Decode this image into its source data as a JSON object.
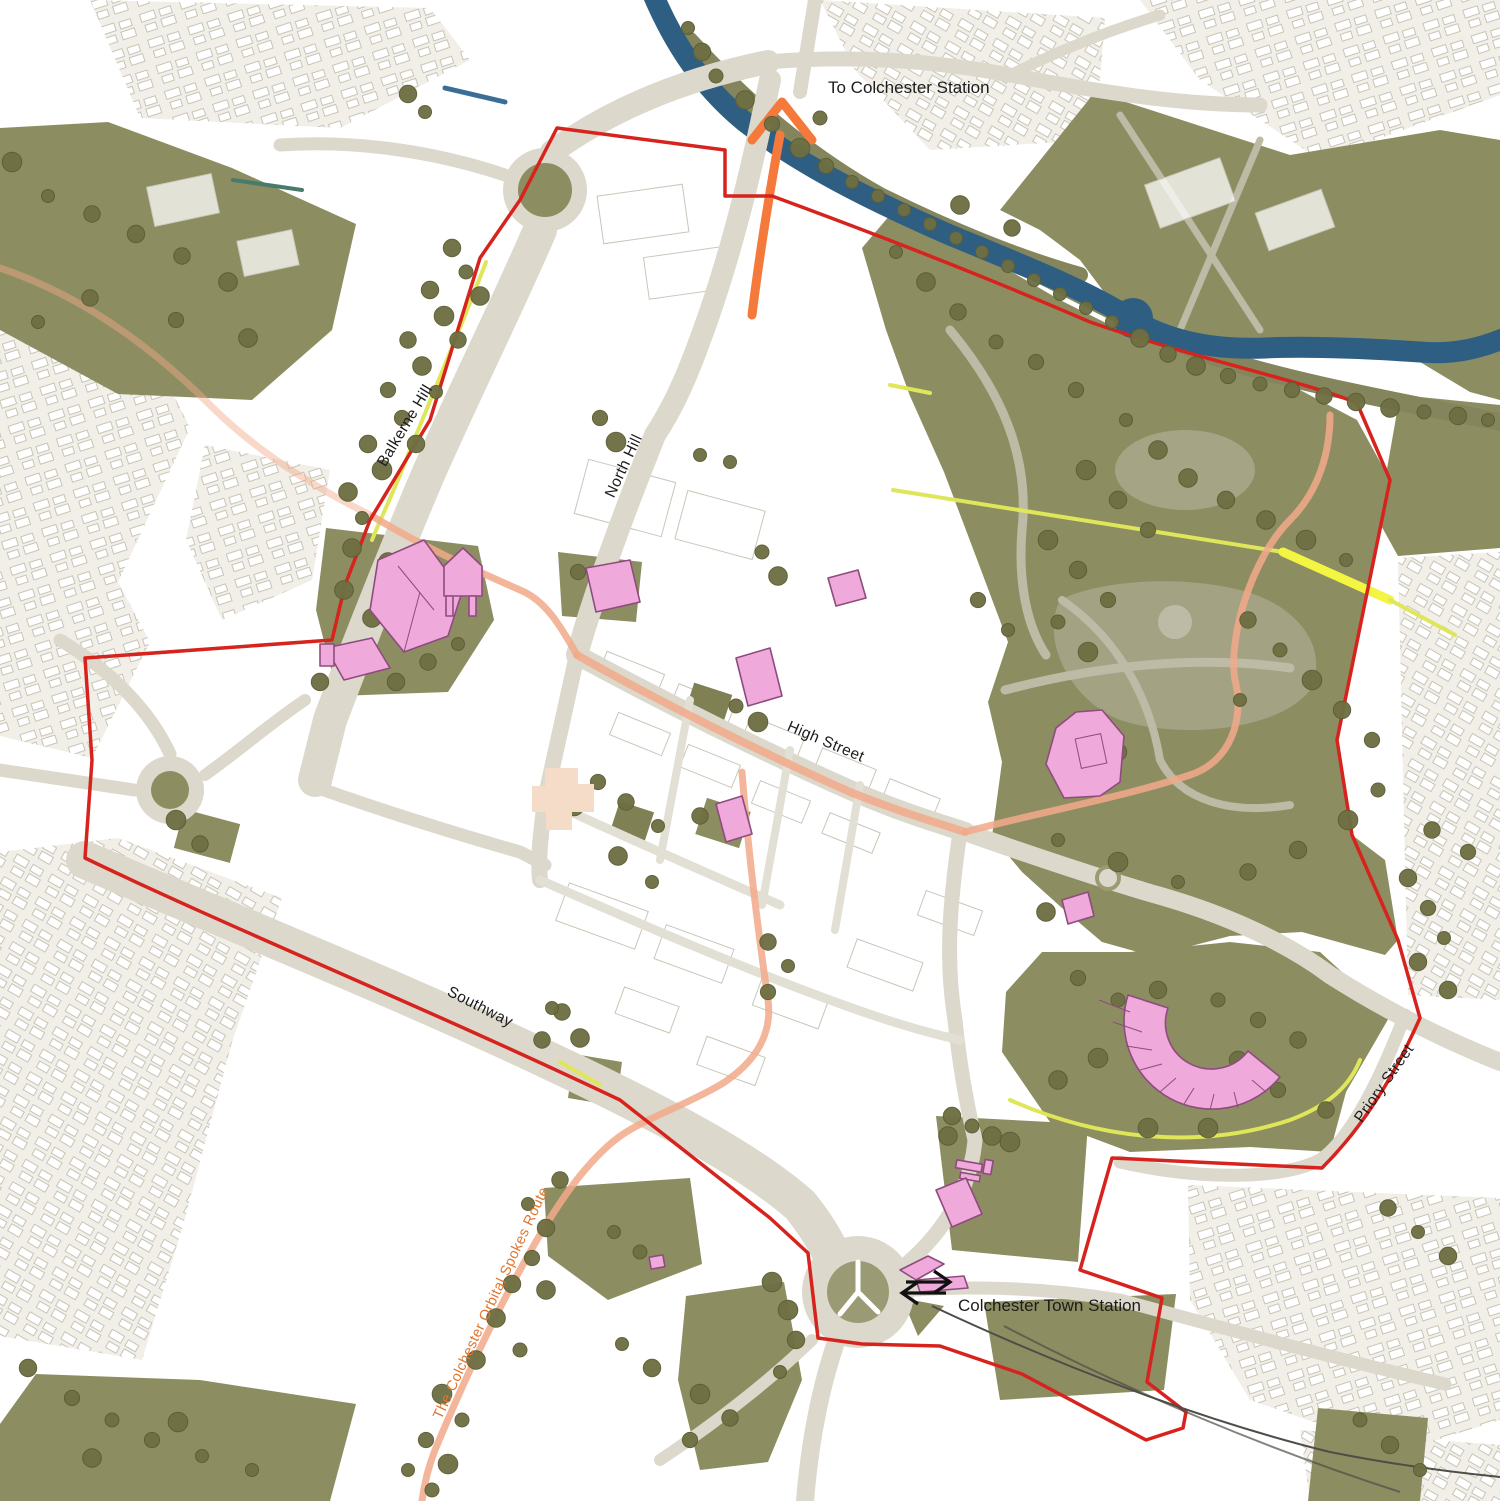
{
  "map": {
    "labels": {
      "to_station": "To Colchester Station",
      "town_station": "Colchester Town Station",
      "balkerne_hill": "Balkerne Hill",
      "north_hill": "North Hill",
      "high_street": "High Street",
      "southway": "Southway",
      "priory_street": "Priory Street",
      "orbital_route": "The Colchester Orbital Spokes Route"
    },
    "colors": {
      "boundary_red": "#d7231d",
      "route_salmon": "#f2a98a",
      "arrow_orange": "#f5793b",
      "cycle_yellow": "#e9ef55",
      "park_olive": "#8d8d62",
      "tree_olive": "#6e6f42",
      "river_blue": "#2e5f82",
      "landmark_pink": "#efa9da",
      "landmark_outline": "#8e4c7e",
      "road_grey": "#dcd9cc",
      "label_text": "#1c1c1c",
      "route_label_orange": "#e0762f"
    },
    "icons": {
      "rail": "national-rail-icon",
      "arrow": "arrow-up-icon"
    }
  }
}
